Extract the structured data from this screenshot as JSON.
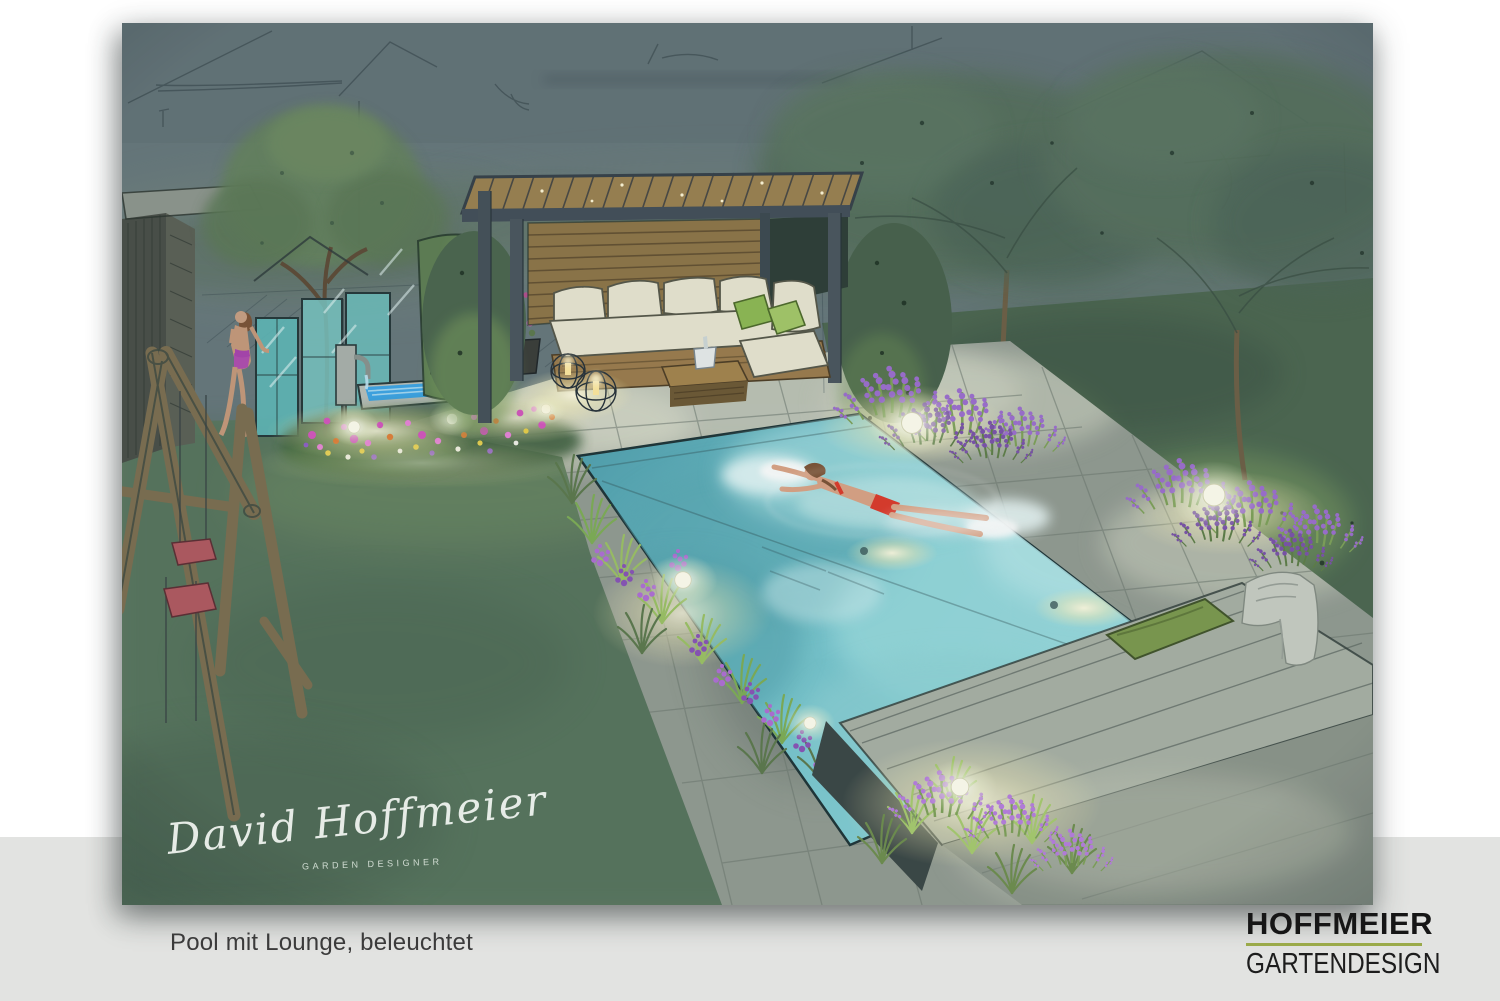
{
  "footer": {
    "caption": "Pool mit Lounge, beleuchtet"
  },
  "brand": {
    "name": "HOFFMEIER",
    "tagline": "GARTENDESIGN"
  },
  "artwork": {
    "signature_name": "David Hoffmeier",
    "signature_title": "GARDEN DESIGNER"
  },
  "palette": {
    "page_bg": "#ffffff",
    "band": "#e2e3e1",
    "caption_ink": "#3b3b3b",
    "brand_ink": "#161616",
    "brand_green": "#9aaa49",
    "sky": "#68797d",
    "lawn": "#5e7b63",
    "hedge": "#4d6852",
    "hedge_lit": "#7fa263",
    "paving": "#939c93",
    "paving_lit": "#c8cdc0",
    "pool_deep": "#4d9fae",
    "pool_mid": "#74c4cd",
    "pool_light": "#c9ecee",
    "pergola_frame": "#44505a",
    "wood": "#a8854f",
    "sofa_cream": "#e9e6d2",
    "pillow_green": "#8fba55",
    "flower_purple": "#a06ed2",
    "light_glow": "#fdf6cf",
    "bikini_red": "#dd3b2c",
    "swing_seat_red": "#b25a61",
    "greenhouse_glass": "#5fbaba",
    "water_feature_blue": "#3fa6e6",
    "deck_wood": "#a9b2a6",
    "cushion_green": "#7d9a50",
    "towel_gray": "#c9cec4",
    "signature_ink": "#eef3ee"
  }
}
